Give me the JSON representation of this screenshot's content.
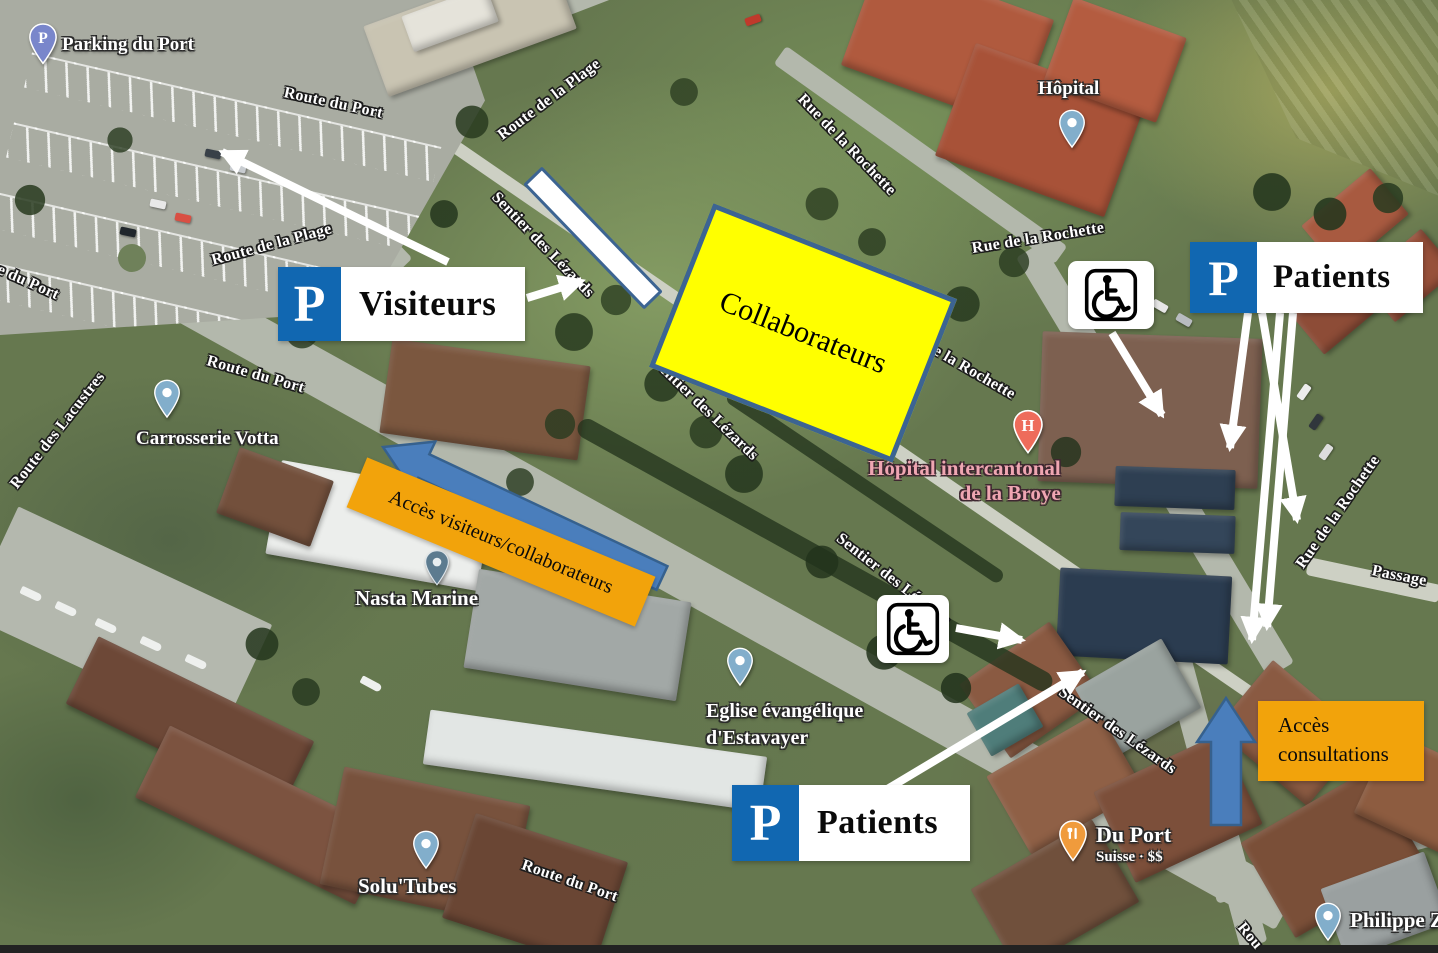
{
  "annotations": {
    "p_symbol": "P",
    "visitors": "Visiteurs",
    "collaborators": "Collaborateurs",
    "patients_top": "Patients",
    "patients_bottom": "Patients",
    "access_visitors_collaborators": "Accès visiteurs/collaborateurs",
    "access_consultations": {
      "line1": "Accès",
      "line2": "consultations"
    },
    "colors": {
      "p_box_blue": "#1167b1",
      "highlight_yellow": "#ffff00",
      "highlight_border_blue": "#3c6492",
      "access_orange": "#f2a30b",
      "arrow_fill_blue": "#4a7ebc",
      "arrow_border_blue": "#36618e",
      "arrow_white": "#ffffff"
    }
  },
  "streets": {
    "route_du_port": "Route du Port",
    "route_de_la_plage": "Route de la Plage",
    "route_des_lacustres": "Route des Lacustres",
    "sentier_des_lezards": "Sentier des Lézards",
    "rue_de_la_rochette": "Rue de la Rochette",
    "passage": "Passage",
    "route_partial": "Rou"
  },
  "places": {
    "parking_du_port": "Parking du Port",
    "hopital": "Hôpital",
    "hospital_area": {
      "line1": "Hôpital intercantonal",
      "line2": "de la Broye"
    },
    "carrosserie_votta": "Carrosserie Votta",
    "nasta_marine": "Nasta Marine",
    "eglise": {
      "line1": "Eglise évangélique",
      "line2": "d'Estavayer"
    },
    "solu_tubes": "Solu'Tubes",
    "du_port": {
      "name": "Du Port",
      "detail": "Suisse · $$"
    },
    "philippe": "Philippe Z",
    "pin_letters": {
      "parking": "P",
      "hospital": "H"
    }
  }
}
